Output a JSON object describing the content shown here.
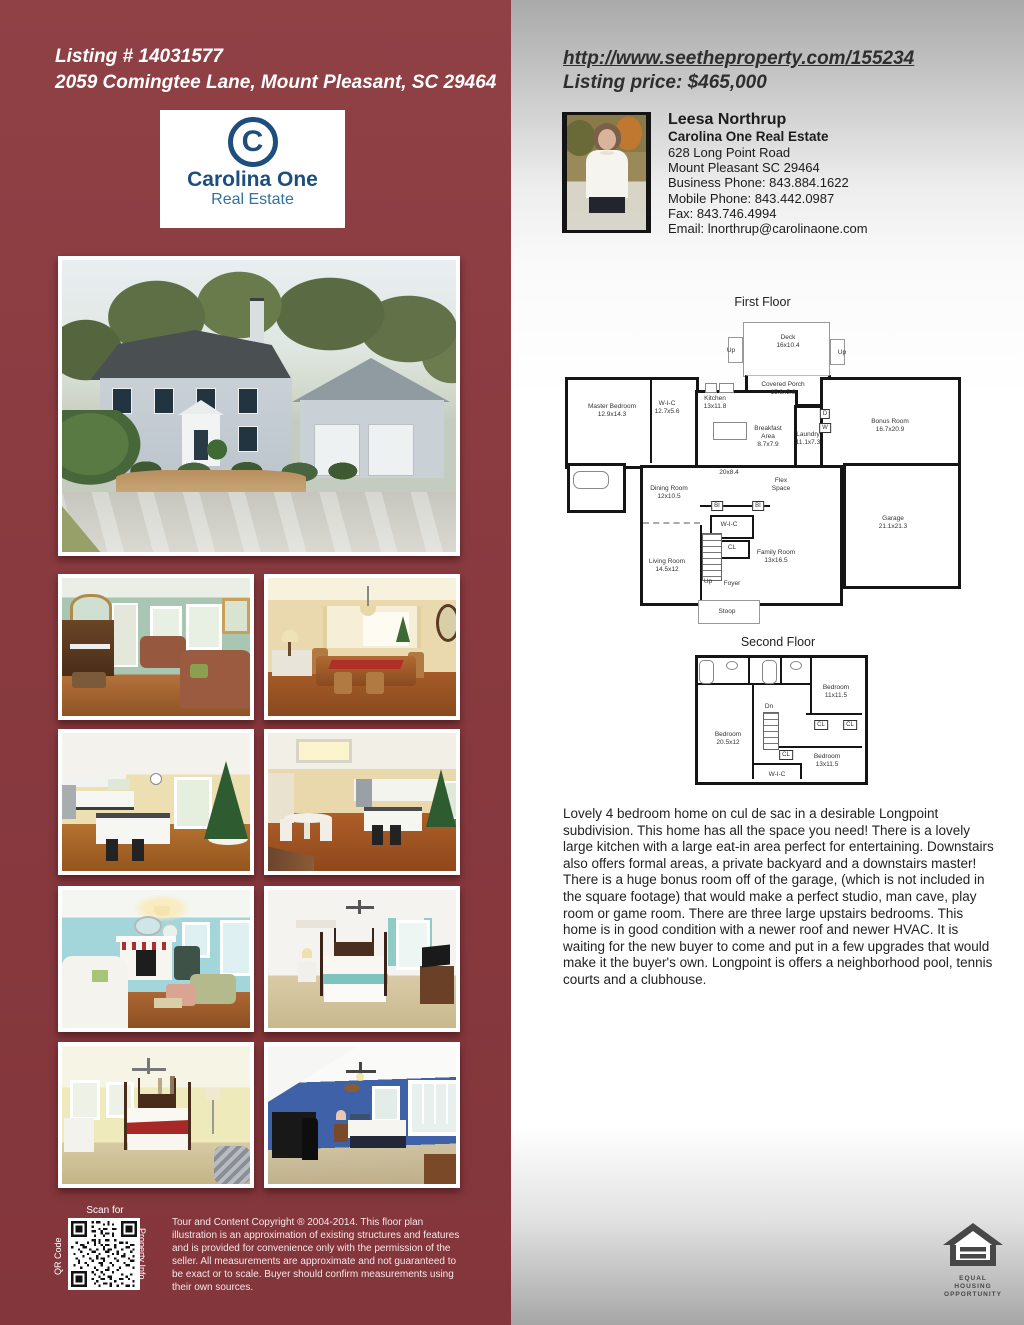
{
  "left_panel": {
    "listing_number": "Listing # 14031577",
    "address": "2059 Comingtee Lane, Mount Pleasant, SC 29464",
    "brand": {
      "monogram": "C",
      "name": "Carolina One",
      "division": "Real Estate"
    },
    "qr": {
      "scan_for": "Scan for",
      "side_left": "QR Code",
      "side_right": "Property Info"
    },
    "disclaimer": "Tour and Content Copyright ® 2004-2014. This floor plan illustration is an approximation of existing structures and features and is provided for convenience only with the permission of the seller. All measurements are approximate and not guaranteed to be exact or to scale. Buyer should confirm measurements using their own sources."
  },
  "right_panel": {
    "url": "http://www.seetheproperty.com/155234",
    "price": "Listing price: $465,000",
    "agent": {
      "name": "Leesa Northrup",
      "company": "Carolina One Real Estate",
      "address_line1": "628 Long Point Road",
      "address_line2": "Mount Pleasant SC 29464",
      "business_phone": "Business Phone: 843.884.1622",
      "mobile_phone": "Mobile Phone: 843.442.0987",
      "fax": "Fax: 843.746.4994",
      "email": "Email: lnorthrup@carolinaone.com"
    },
    "description": "Lovely 4 bedroom home on cul de sac in a desirable Longpoint subdivision. This home has all the space you need! There is a lovely large kitchen with a large eat-in area perfect for entertaining. Downstairs also offers formal areas, a private backyard and a downstairs master! There is a huge bonus room off of the garage, (which is not included in the square footage) that would make a perfect studio, man cave, play room or game room. There are three large upstairs bedrooms. This home is in good condition with a newer roof and newer HVAC. It is waiting for the new buyer to come and put in a few upgrades that would make it the buyer's own. Longpoint is offers a neighborhood pool, tennis courts and a clubhouse.",
    "equal_housing": {
      "line1": "EQUAL HOUSING",
      "line2": "OPPORTUNITY"
    }
  },
  "floor_plans": {
    "first": {
      "title": "First Floor",
      "rooms": [
        {
          "lines": [
            "Deck",
            "16x10.4"
          ],
          "x": 233,
          "y": 49
        },
        {
          "lines": [
            "Up"
          ],
          "x": 176,
          "y": 58
        },
        {
          "lines": [
            "Up"
          ],
          "x": 287,
          "y": 60
        },
        {
          "lines": [
            "Covered Porch",
            "15.8x5.8"
          ],
          "x": 228,
          "y": 96
        },
        {
          "lines": [
            "Master Bedroom",
            "12.9x14.3"
          ],
          "x": 57,
          "y": 118
        },
        {
          "lines": [
            "W-I-C",
            "12.7x5.6"
          ],
          "x": 112,
          "y": 115
        },
        {
          "lines": [
            "Kitchen",
            "13x11.8"
          ],
          "x": 160,
          "y": 110
        },
        {
          "lines": [
            "Breakfast",
            "Area",
            "8.7x7.9"
          ],
          "x": 213,
          "y": 144
        },
        {
          "lines": [
            "Laundry",
            "11.1x7.3"
          ],
          "x": 253,
          "y": 146
        },
        {
          "lines": [
            "D"
          ],
          "x": 270,
          "y": 121,
          "box": true
        },
        {
          "lines": [
            "W"
          ],
          "x": 270,
          "y": 135,
          "box": true
        },
        {
          "lines": [
            "Bonus Room",
            "16.7x20.9"
          ],
          "x": 335,
          "y": 133
        },
        {
          "lines": [
            "20x8.4"
          ],
          "x": 174,
          "y": 180
        },
        {
          "lines": [
            "Flex",
            "Space"
          ],
          "x": 226,
          "y": 192
        },
        {
          "lines": [
            "Dining Room",
            "12x10.5"
          ],
          "x": 114,
          "y": 200
        },
        {
          "lines": [
            "BI"
          ],
          "x": 162,
          "y": 213,
          "box": true
        },
        {
          "lines": [
            "BI"
          ],
          "x": 203,
          "y": 213,
          "box": true
        },
        {
          "lines": [
            "Garage",
            "21.1x21.3"
          ],
          "x": 338,
          "y": 230
        },
        {
          "lines": [
            "W-I-C"
          ],
          "x": 174,
          "y": 232
        },
        {
          "lines": [
            "CL"
          ],
          "x": 177,
          "y": 255
        },
        {
          "lines": [
            "Living Room",
            "14.5x12"
          ],
          "x": 112,
          "y": 273
        },
        {
          "lines": [
            "Family Room",
            "13x16.5"
          ],
          "x": 221,
          "y": 264
        },
        {
          "lines": [
            "Up"
          ],
          "x": 153,
          "y": 289
        },
        {
          "lines": [
            "Foyer"
          ],
          "x": 177,
          "y": 291
        },
        {
          "lines": [
            "Stoop"
          ],
          "x": 172,
          "y": 319
        }
      ]
    },
    "second": {
      "title": "Second Floor",
      "rooms": [
        {
          "lines": [
            "Dn"
          ],
          "x": 129,
          "y": 74
        },
        {
          "lines": [
            "Bedroom",
            "11x11.5"
          ],
          "x": 196,
          "y": 59
        },
        {
          "lines": [
            "CL"
          ],
          "x": 181,
          "y": 92,
          "box": true
        },
        {
          "lines": [
            "CL"
          ],
          "x": 210,
          "y": 92,
          "box": true
        },
        {
          "lines": [
            "Bedroom",
            "20.5x12"
          ],
          "x": 88,
          "y": 106
        },
        {
          "lines": [
            "CL"
          ],
          "x": 146,
          "y": 122,
          "box": true
        },
        {
          "lines": [
            "Bedroom",
            "13x11.5"
          ],
          "x": 187,
          "y": 128
        },
        {
          "lines": [
            "W-I-C"
          ],
          "x": 137,
          "y": 142
        }
      ]
    }
  },
  "colors": {
    "maroon": "#883a3f",
    "navy": "#1d4e7e"
  }
}
